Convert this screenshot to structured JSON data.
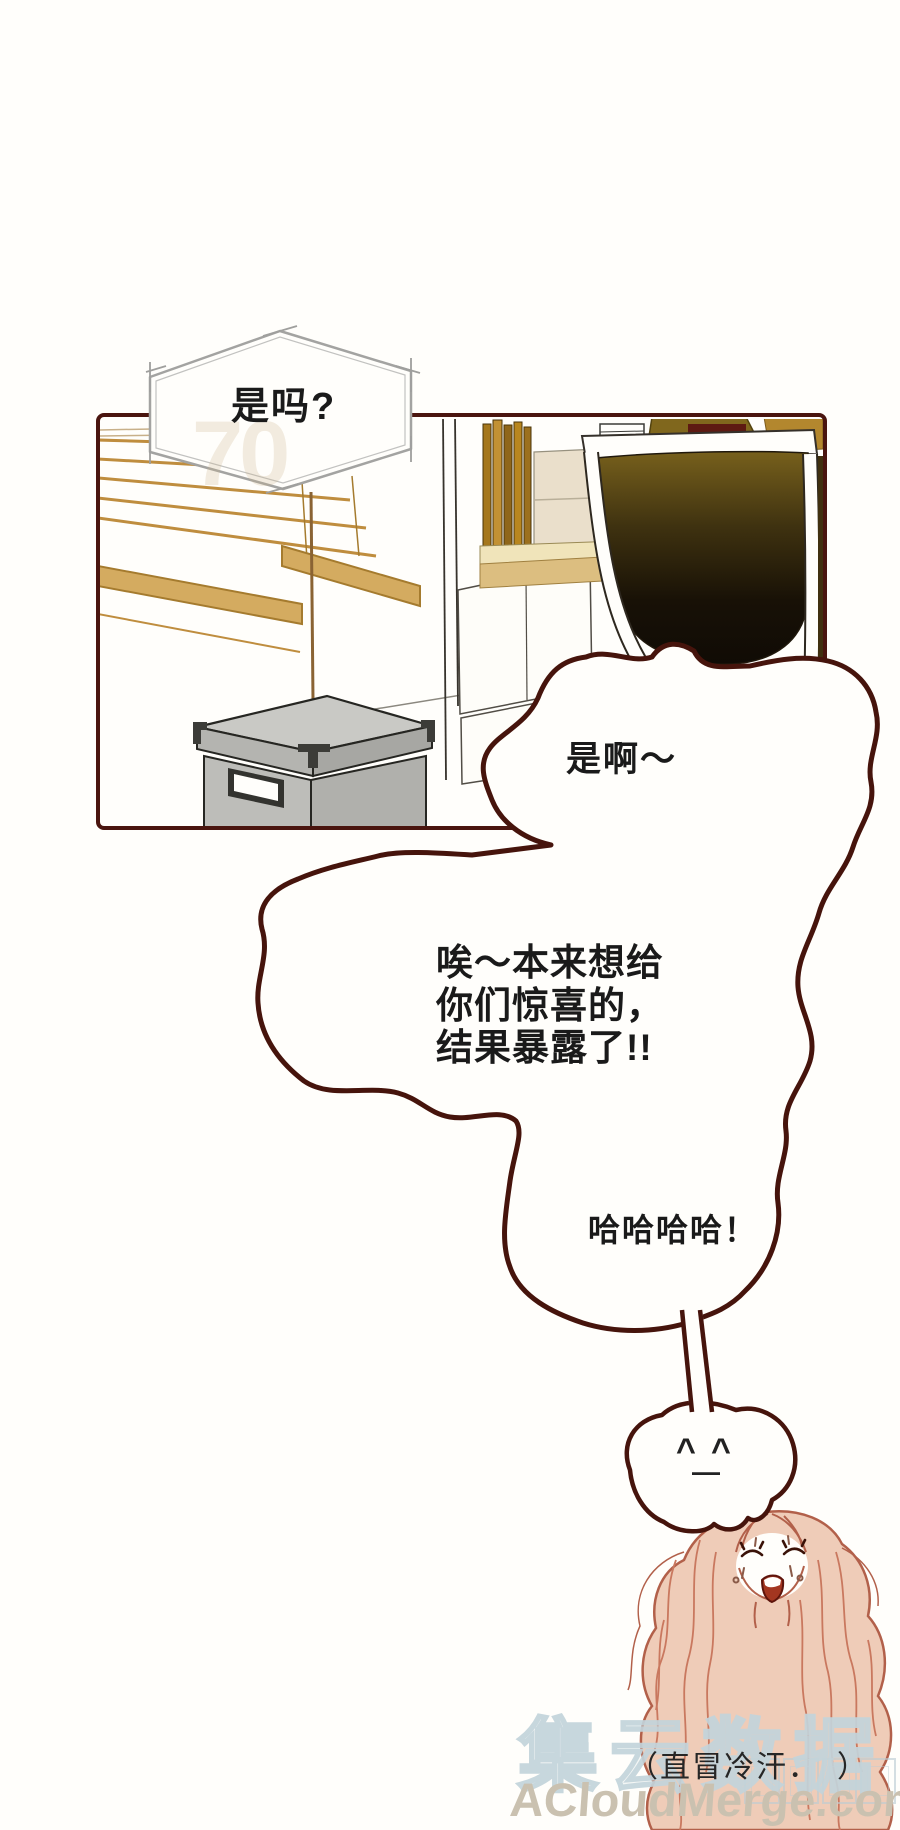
{
  "comic": {
    "hexagon_bubble": {
      "text": "是吗?"
    },
    "reply_bubble": {
      "text": "是啊～"
    },
    "main_bubble": {
      "lines": [
        "唉～本来想给",
        "你们惊喜的，",
        "结果暴露了!!"
      ]
    },
    "laugh_bubble": {
      "text": "哈哈哈哈！"
    },
    "cloud_face": {
      "eye_left": "^",
      "eye_right": "^",
      "mouth": "—"
    },
    "caption": {
      "text": "（直冒冷汗．　）"
    },
    "faint_mark": "70",
    "watermark": {
      "brand_cn": "集云数据",
      "brand_url": "ACloudMerge.com"
    }
  },
  "colors": {
    "outline": "#46140c",
    "panel-border": "#4a150f",
    "hex-border": "#a3a3a1",
    "wm-blue": "#c3d4db",
    "wm-tan": "#cac1b0",
    "hair-fill": "#efccb8",
    "hair-line": "#b2604a",
    "blind-tan": "#bf8d3e"
  }
}
